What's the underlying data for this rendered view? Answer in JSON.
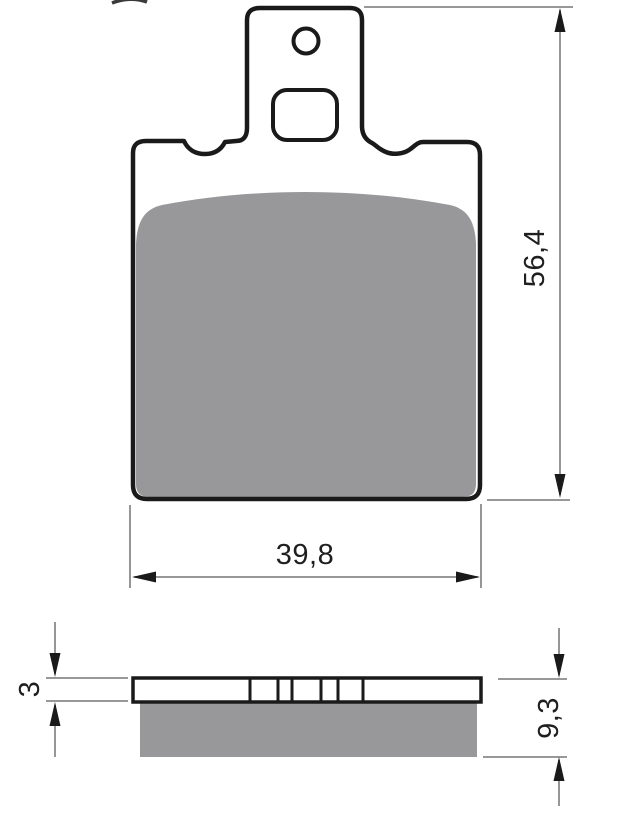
{
  "figure": {
    "labels": {
      "height": "56,4",
      "width": "39,8",
      "backing_thickness": "3",
      "total_thickness": "9,3"
    },
    "views": {
      "front": "brake-pad-front-view",
      "side": "brake-pad-side-section-view"
    },
    "colors": {
      "outline": "#1a1a1a",
      "friction_gray": "#98989a",
      "dimension_line": "#8a8a8a",
      "text": "#1f1f1f",
      "background": "#ffffff"
    }
  }
}
